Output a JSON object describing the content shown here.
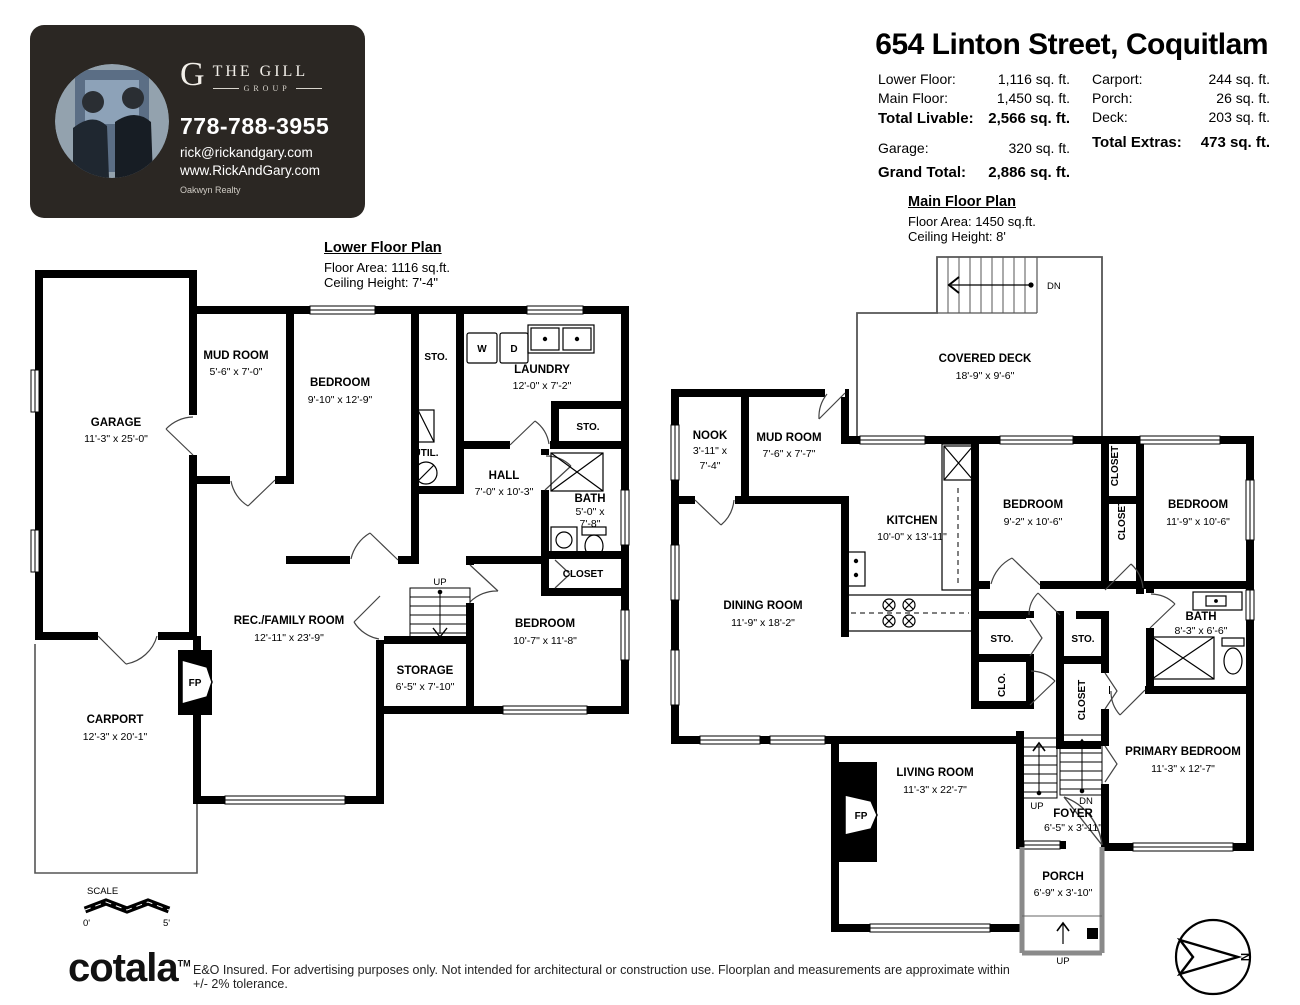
{
  "header": {
    "title": "654 Linton Street, Coquitlam",
    "stats_left": [
      {
        "label": "Lower Floor:",
        "value": "1,116 sq. ft."
      },
      {
        "label": "Main Floor:",
        "value": "1,450 sq. ft."
      },
      {
        "label": "Total Livable:",
        "value": "2,566 sq. ft."
      },
      {
        "label": "Garage:",
        "value": "320 sq. ft."
      },
      {
        "label": "Grand Total:",
        "value": "2,886 sq. ft."
      }
    ],
    "stats_right": [
      {
        "label": "Carport:",
        "value": "244 sq. ft."
      },
      {
        "label": "Porch:",
        "value": "26 sq. ft."
      },
      {
        "label": "Deck:",
        "value": "203 sq. ft."
      },
      {
        "label": "Total Extras:",
        "value": "473 sq. ft."
      }
    ]
  },
  "agent_card": {
    "monogram": "G",
    "brand_top": "THE GILL",
    "brand_bottom": "GROUP",
    "phone": "778-788-3955",
    "email": "rick@rickandgary.com",
    "website": "www.RickAndGary.com",
    "brokerage": "Oakwyn Realty"
  },
  "lower": {
    "title": "Lower Floor Plan",
    "area": "Floor Area: 1116 sq.ft.",
    "ceiling": "Ceiling Height: 7'-4\"",
    "rooms": {
      "garage": {
        "name": "GARAGE",
        "dims": "11'-3\" x 25'-0\""
      },
      "mud": {
        "name": "MUD ROOM",
        "dims": "5'-6\" x 7'-0\""
      },
      "bedroom1": {
        "name": "BEDROOM",
        "dims": "9'-10\" x 12'-9\""
      },
      "sto_top": {
        "name": "STO."
      },
      "laundry": {
        "name": "LAUNDRY",
        "dims": "12'-0\" x 7'-2\""
      },
      "util": {
        "name": "UTIL."
      },
      "hall": {
        "name": "HALL",
        "dims": "7'-0\" x 10'-3\""
      },
      "sto_right": {
        "name": "STO."
      },
      "bath": {
        "name": "BATH",
        "dims1": "5'-0\" x",
        "dims2": "7'-8\""
      },
      "closet": {
        "name": "CLOSET"
      },
      "bedroom2": {
        "name": "BEDROOM",
        "dims": "10'-7\" x 11'-8\""
      },
      "storage": {
        "name": "STORAGE",
        "dims": "6'-5\" x 7'-10\""
      },
      "rec": {
        "name": "REC./FAMILY ROOM",
        "dims": "12'-11\" x 23'-9\""
      },
      "carport": {
        "name": "CARPORT",
        "dims": "12'-3\" x 20'-1\""
      }
    },
    "labels": {
      "up": "UP",
      "fp": "FP",
      "w": "W",
      "d": "D"
    }
  },
  "main": {
    "title": "Main Floor Plan",
    "area": "Floor Area: 1450 sq.ft.",
    "ceiling": "Ceiling Height: 8'",
    "rooms": {
      "deck": {
        "name": "COVERED DECK",
        "dims": "18'-9\" x 9'-6\""
      },
      "nook": {
        "name": "NOOK",
        "dims1": "3'-11\" x",
        "dims2": "7'-4\""
      },
      "mud": {
        "name": "MUD ROOM",
        "dims": "7'-6\" x 7'-7\""
      },
      "kitchen": {
        "name": "KITCHEN",
        "dims": "10'-0\" x 13'-11\""
      },
      "bedroom1": {
        "name": "BEDROOM",
        "dims": "9'-2\" x 10'-6\""
      },
      "bedroom2": {
        "name": "BEDROOM",
        "dims": "11'-9\" x 10'-6\""
      },
      "closet1": {
        "name": "CLOSET"
      },
      "closet2": {
        "name": "CLOSET"
      },
      "dining": {
        "name": "DINING ROOM",
        "dims": "11'-9\" x 18'-2\""
      },
      "sto1": {
        "name": "STO."
      },
      "clo": {
        "name": "CLO."
      },
      "sto2": {
        "name": "STO."
      },
      "closet3": {
        "name": "CLOSET"
      },
      "bath": {
        "name": "BATH",
        "dims": "8'-3\" x 6'-6\""
      },
      "primary": {
        "name": "PRIMARY BEDROOM",
        "dims": "11'-3\" x 12'-7\""
      },
      "living": {
        "name": "LIVING ROOM",
        "dims": "11'-3\" x 22'-7\""
      },
      "foyer": {
        "name": "FOYER",
        "dims": "6'-5\" x 3'-11\""
      },
      "porch": {
        "name": "PORCH",
        "dims": "6'-9\" x 3'-10\""
      }
    },
    "labels": {
      "dn1": "DN",
      "up1": "UP",
      "dn2": "DN",
      "up2": "UP",
      "fp": "FP"
    }
  },
  "scale": {
    "label": "SCALE",
    "start": "0'",
    "end": "5'"
  },
  "compass": {
    "n": "N"
  },
  "footer": {
    "brand": "cotala",
    "tm": "TM",
    "disclaimer": "E&O Insured. For advertising purposes only. Not intended for architectural or construction use. Floorplan and measurements are approximate within +/- 2% tolerance."
  }
}
